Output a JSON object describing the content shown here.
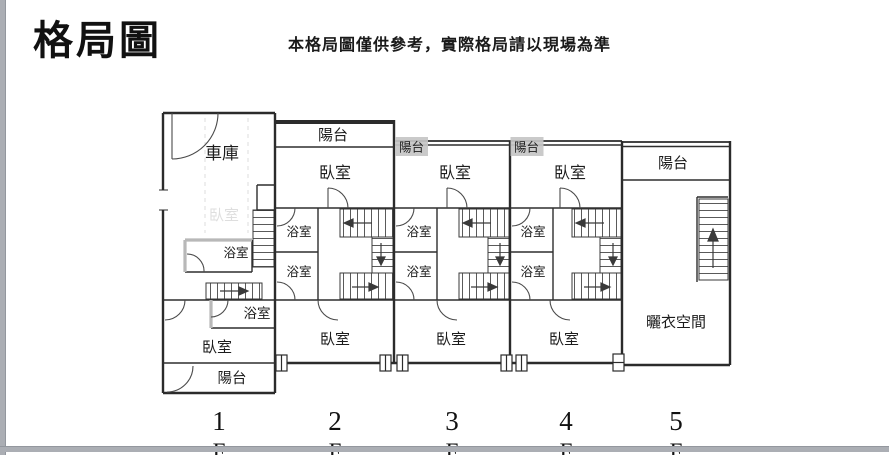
{
  "header": {
    "title": "格局圖",
    "disclaimer": "本格局圖僅供參考，實際格局請以現場為準"
  },
  "plan": {
    "unit1": {
      "garage": "車庫",
      "ghost_room": "臥室",
      "bath_upper": "浴室",
      "bath_lower": "浴室",
      "bedroom": "臥室",
      "balcony": "陽台"
    },
    "unit2": {
      "balcony": "陽台",
      "bedroom_top": "臥室",
      "bath_upper": "浴室",
      "bath_lower": "浴室",
      "bedroom_bottom": "臥室"
    },
    "unit3": {
      "balcony": "陽台",
      "bedroom_top": "臥室",
      "bath_upper": "浴室",
      "bath_lower": "浴室",
      "bedroom_bottom": "臥室"
    },
    "unit4": {
      "balcony": "陽台",
      "bedroom_top": "臥室",
      "bath_upper": "浴室",
      "bath_lower": "浴室",
      "bedroom_bottom": "臥室"
    },
    "unit5": {
      "balcony": "陽台",
      "drying_space": "曬衣空間"
    }
  },
  "floors": [
    {
      "number": "1",
      "suffix": "F"
    },
    {
      "number": "2",
      "suffix": "F"
    },
    {
      "number": "3",
      "suffix": "F"
    },
    {
      "number": "4",
      "suffix": "F"
    },
    {
      "number": "5",
      "suffix": "F"
    }
  ],
  "colors": {
    "wall": "#2b2b2b",
    "highlight": "#c6c6c6",
    "frame_bar": "#abaeb4"
  }
}
